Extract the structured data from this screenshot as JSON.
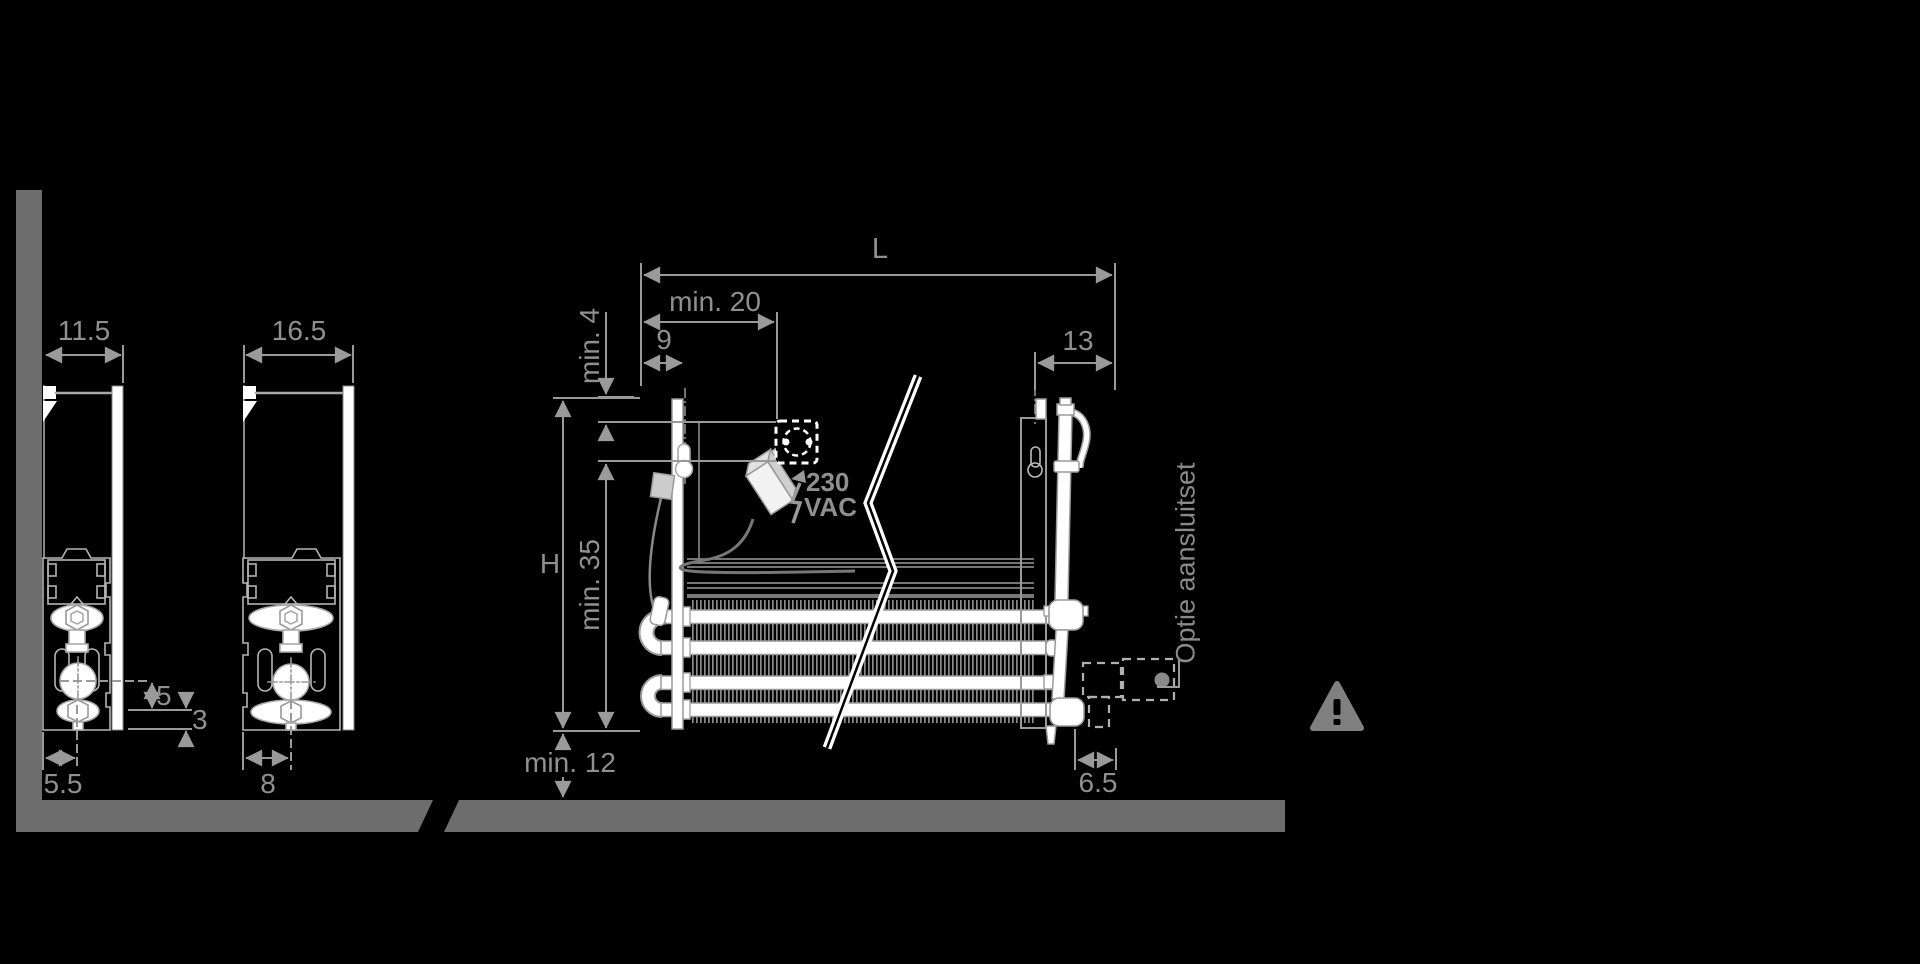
{
  "canvas": {
    "width": 1920,
    "height": 964,
    "background": "#000000"
  },
  "colors": {
    "wall_floor": "#6d6d6d",
    "dim_line": "#9a9a9a",
    "dim_text": "#909090",
    "drawing_white": "#ffffff",
    "warning_gray": "#808080"
  },
  "left_section_small": {
    "depth_label": "11.5",
    "wall_offset_label": "5.5",
    "pipe_to_valve_label": "5",
    "valve_to_bottom_label": "3"
  },
  "left_section_large": {
    "depth_label": "16.5",
    "center_offset_label": "8"
  },
  "main_view": {
    "length_label": "L",
    "min_socket_distance_label": "min. 20",
    "hang_offset_label": "9",
    "right_offset_label": "13",
    "min_top_clearance_label": "min. 4",
    "min_socket_bottom_label": "min. 35",
    "height_label": "H",
    "min_floor_clearance_label": "min. 12",
    "connection_offset_label": "6.5",
    "voltage_value": "230",
    "voltage_unit": "VAC",
    "option_label": "Optie aansluitset"
  },
  "icons": {
    "socket": "power-socket-icon",
    "adapter": "power-adapter-icon",
    "bolt": "lightning-bolt-icon",
    "warning": "warning-triangle-icon",
    "break": "break-line-mark",
    "junction": "junction-box-icon"
  }
}
